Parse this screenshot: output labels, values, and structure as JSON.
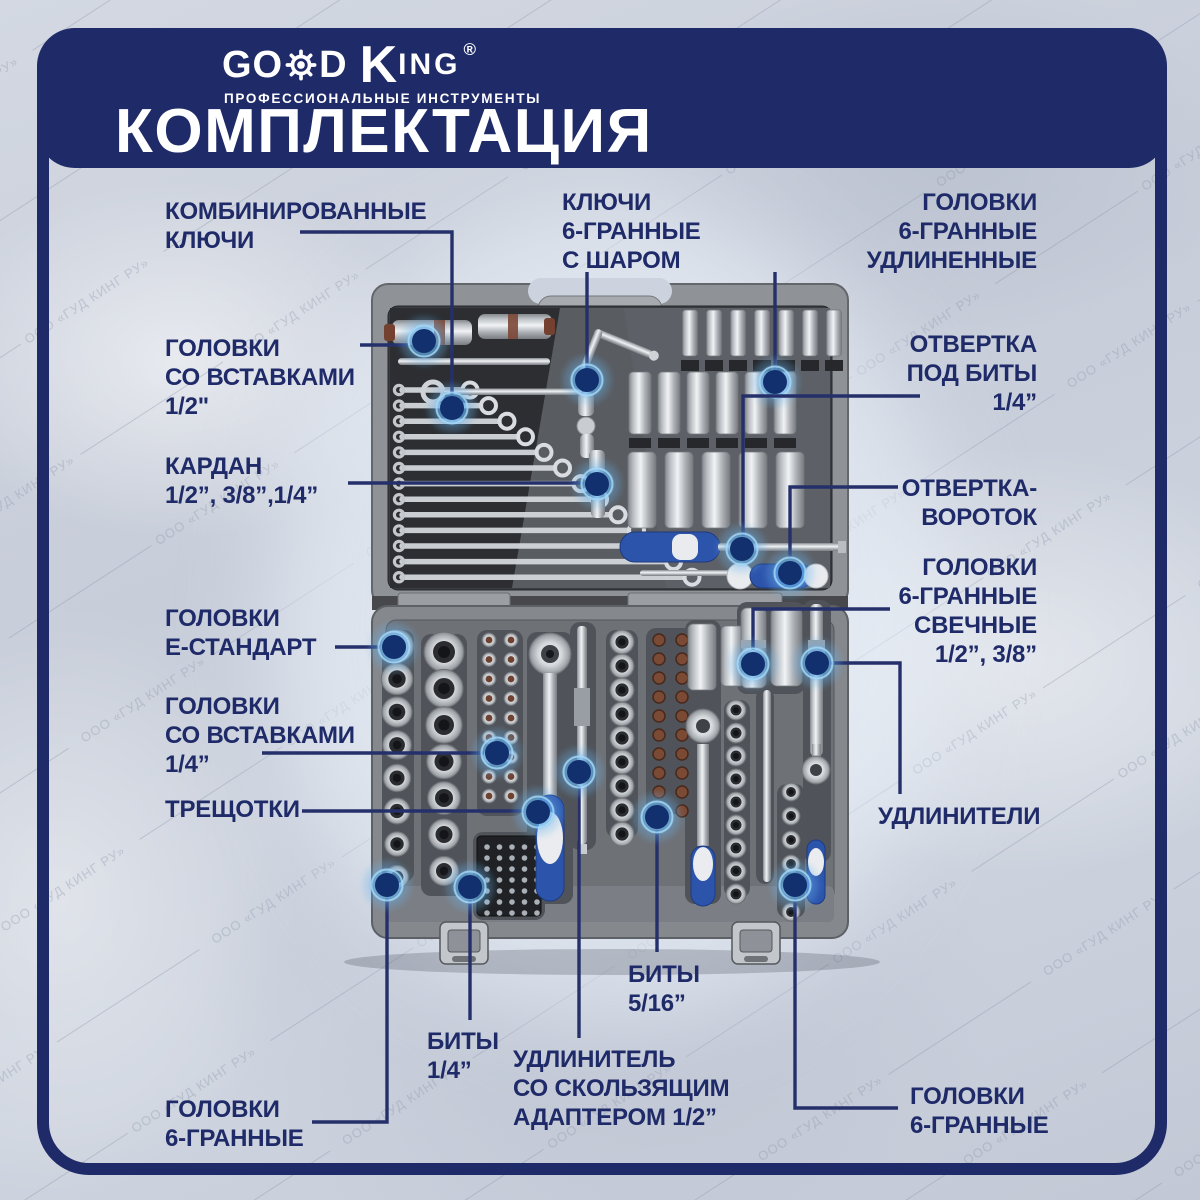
{
  "header": {
    "brand": {
      "go": "GO",
      "d": "D",
      "king_k": "K",
      "king_rest": "ING",
      "reg": "®"
    },
    "tagline": "ПРОФЕССИОНАЛЬНЫЕ ИНСТРУМЕНТЫ",
    "title": "КОМПЛЕКТАЦИЯ"
  },
  "watermark": "ООО «ГУД КИНГ РУ»",
  "colors": {
    "navy": "#1f2a68",
    "leader_line": "#25306b",
    "marker_core": "#12306e",
    "marker_glow": "#63b1ee",
    "background": "#cbd1dc",
    "case_gray": "#8f9297",
    "handle_blue": "#2d54ab"
  },
  "callouts": [
    {
      "id": "combination-wrenches",
      "lines": [
        "КОМБИНИРОВАННЫЕ",
        "КЛЮЧИ"
      ],
      "align": "left",
      "x": 165,
      "top": 197,
      "marker": {
        "x": 452,
        "y": 408
      },
      "path": "M 300,232 H 452 V 396"
    },
    {
      "id": "hex-keys-ball",
      "lines": [
        "КЛЮЧИ",
        "6-ГРАННЫЕ",
        "С ШАРОМ"
      ],
      "align": "left",
      "x": 562,
      "top": 188,
      "marker": {
        "x": 587,
        "y": 380
      },
      "path": "M 587,272 V 368"
    },
    {
      "id": "sockets-hex-long",
      "lines": [
        "ГОЛОВКИ",
        "6-ГРАННЫЕ",
        "УДЛИНЕННЫЕ"
      ],
      "align": "right",
      "x": 1037,
      "top": 188,
      "marker": {
        "x": 775,
        "y": 382
      },
      "path": "M 775,272 V 370"
    },
    {
      "id": "sockets-with-inserts-1-2",
      "lines": [
        "ГОЛОВКИ",
        "СО ВСТАВКАМИ",
        "1/2\""
      ],
      "align": "left",
      "x": 165,
      "top": 334,
      "marker": {
        "x": 424,
        "y": 341
      },
      "path": "M 360,345 H 408"
    },
    {
      "id": "screwdriver-for-bits",
      "lines": [
        "ОТВЕРТКА",
        "ПОД БИТЫ",
        "1/4”"
      ],
      "align": "right",
      "x": 1037,
      "top": 330,
      "marker": {
        "x": 742,
        "y": 549
      },
      "path": "M 920,396 H 743 V 536"
    },
    {
      "id": "cardan",
      "lines": [
        "КАРДАН",
        "1/2”, 3/8”,1/4”"
      ],
      "align": "left",
      "x": 165,
      "top": 452,
      "marker": {
        "x": 597,
        "y": 484
      },
      "path": "M 348,483 H 584"
    },
    {
      "id": "screwdriver-t-handle",
      "lines": [
        "ОТВЕРТКА-",
        "ВОРОТОК"
      ],
      "align": "right",
      "x": 1037,
      "top": 474,
      "marker": {
        "x": 790,
        "y": 573
      },
      "path": "M 898,487 H 790 V 558"
    },
    {
      "id": "spark-plug-sockets",
      "lines": [
        "ГОЛОВКИ",
        "6-ГРАННЫЕ",
        "СВЕЧНЫЕ",
        "1/2”, 3/8”"
      ],
      "align": "right",
      "x": 1037,
      "top": 553,
      "marker": {
        "x": 753,
        "y": 664
      },
      "path": "M 890,609 H 753 V 650"
    },
    {
      "id": "sockets-e-standard",
      "lines": [
        "ГОЛОВКИ",
        "Е-СТАНДАРТ"
      ],
      "align": "left",
      "x": 165,
      "top": 604,
      "marker": {
        "x": 394,
        "y": 647
      },
      "path": "M 335,647 H 380"
    },
    {
      "id": "sockets-with-inserts-1-4",
      "lines": [
        "ГОЛОВКИ",
        "СО ВСТАВКАМИ",
        "1/4”"
      ],
      "align": "left",
      "x": 165,
      "top": 692,
      "marker": {
        "x": 497,
        "y": 753
      },
      "path": "M 262,753 H 484"
    },
    {
      "id": "ratchets",
      "lines": [
        "ТРЕЩОТКИ"
      ],
      "align": "left",
      "x": 165,
      "top": 795,
      "marker": {
        "x": 538,
        "y": 812
      },
      "path": "M 302,811 H 524"
    },
    {
      "id": "extensions",
      "lines": [
        "УДЛИНИТЕЛИ"
      ],
      "align": "left",
      "x": 878,
      "top": 802,
      "marker": {
        "x": 817,
        "y": 663
      },
      "path": "M 830,663 H 900 V 794"
    },
    {
      "id": "bits-5-16",
      "lines": [
        "БИТЫ",
        "5/16”"
      ],
      "align": "left",
      "x": 628,
      "top": 960,
      "marker": {
        "x": 657,
        "y": 817
      },
      "path": "M 657,830 V 952"
    },
    {
      "id": "bits-1-4",
      "lines": [
        "БИТЫ",
        "1/4”"
      ],
      "align": "left",
      "x": 427,
      "top": 1027,
      "marker": {
        "x": 470,
        "y": 887
      },
      "path": "M 470,900 V 1020"
    },
    {
      "id": "extension-sliding-adapter",
      "lines": [
        "УДЛИНИТЕЛЬ",
        "СО СКОЛЬЗЯЩИМ",
        "АДАПТЕРОМ 1/2”"
      ],
      "align": "left",
      "x": 513,
      "top": 1045,
      "marker": {
        "x": 579,
        "y": 772
      },
      "path": "M 579,786 V 1038"
    },
    {
      "id": "sockets-hex-left",
      "lines": [
        "ГОЛОВКИ",
        "6-ГРАННЫЕ"
      ],
      "align": "left",
      "x": 165,
      "top": 1095,
      "marker": {
        "x": 387,
        "y": 885
      },
      "path": "M 387,898 V 1122 H 312"
    },
    {
      "id": "sockets-hex-right",
      "lines": [
        "ГОЛОВКИ",
        "6-ГРАННЫЕ"
      ],
      "align": "left",
      "x": 910,
      "top": 1082,
      "marker": {
        "x": 795,
        "y": 885
      },
      "path": "M 795,898 V 1108 H 898"
    }
  ]
}
